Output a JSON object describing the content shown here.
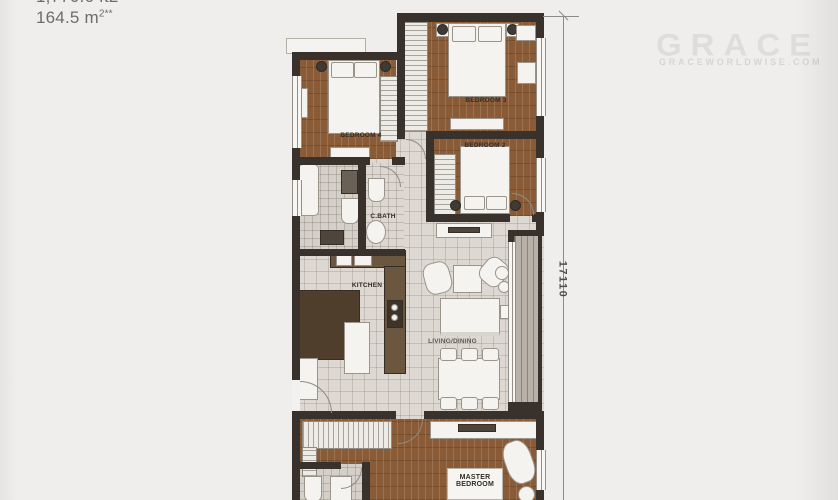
{
  "header": {
    "area_partial": "1,770.6 ft2**",
    "area_value": "164.5 m",
    "area_sup": "2",
    "area_stars": "**"
  },
  "watermark": {
    "brand": "GRACE",
    "site": "GRACEWORLDWISE.COM"
  },
  "dimension": {
    "side_label": "17110"
  },
  "rooms": {
    "bedroom3": "BEDROOM 3",
    "bedroom4": "BEDROOM 4",
    "bedroom2": "BEDROOM 2",
    "cbath": "C.BATH",
    "kitchen": "KITCHEN",
    "living": "LIVING/DINING",
    "master1": "MASTER",
    "master2": "BEDROOM"
  },
  "colors": {
    "background": "#efeeec",
    "wall": "#39322c",
    "wood_floor": "#8a5b37",
    "tile_floor": "#ddd9d2",
    "watermark_text": "#dedddb",
    "dimension_line": "#8b8b8b"
  }
}
